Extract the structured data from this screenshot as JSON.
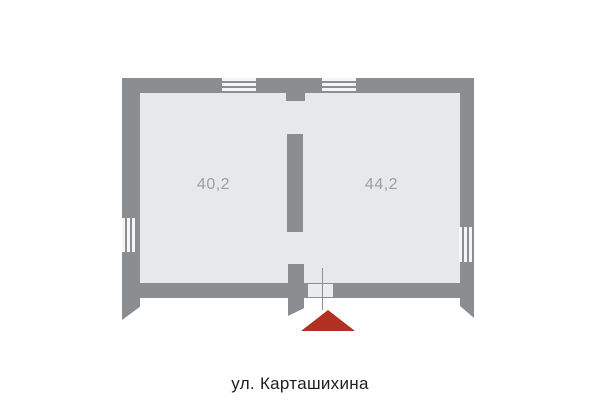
{
  "plan": {
    "street": {
      "label": "ул. Карташихина"
    },
    "rooms": [
      {
        "id": "left",
        "area": "40,2"
      },
      {
        "id": "right",
        "area": "44,2"
      }
    ]
  },
  "colors": {
    "wall": "#8a8e91",
    "floor": "#e7e8ea",
    "window-stripe": "#f4f5f5",
    "door": "#ebecee",
    "marker": "#b23122",
    "room-label": "#9ba0a4",
    "street-label": "#1e1e1e",
    "background": "#ffffff"
  }
}
